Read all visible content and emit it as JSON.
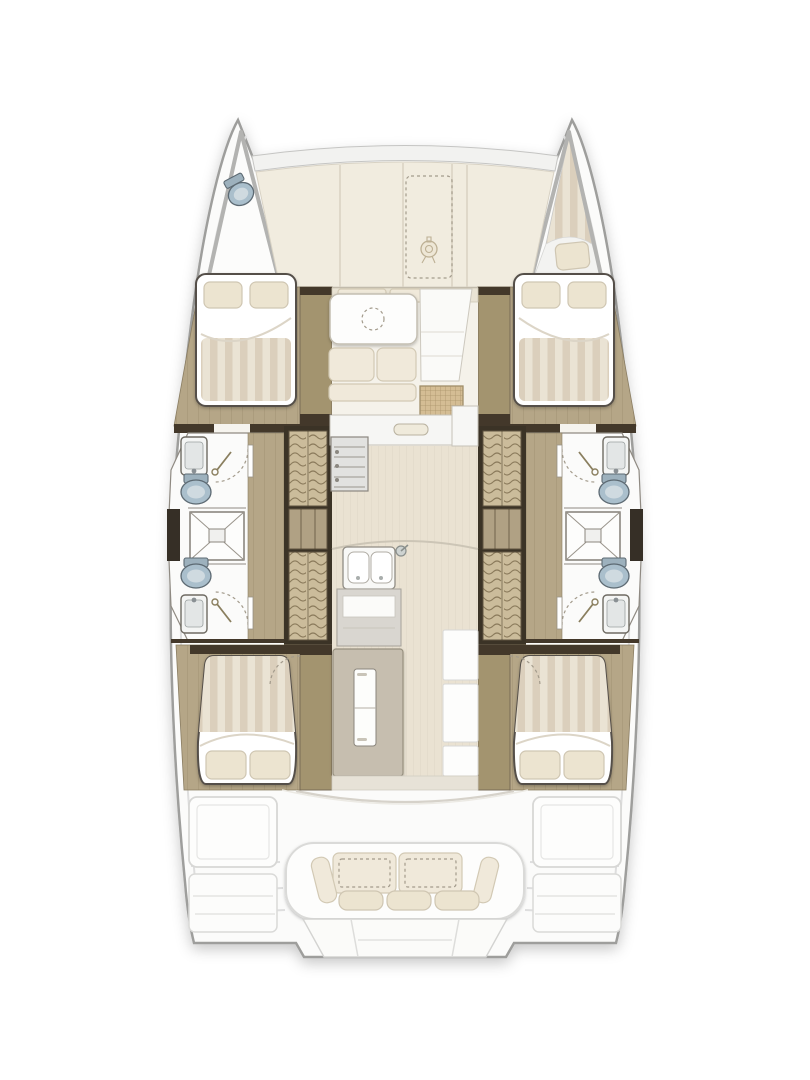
{
  "title": "Catamaran yacht deck floor plan, top view: four double cabins, four bathrooms with showers, twin companionway stairs, central salon with galley and dinette, foredeck anchor locker with windlass, aft cockpit bench sofa and swim-platform steps",
  "diagram": {
    "type": "floor-plan",
    "vessel": "sailing catamaran",
    "areas": {
      "bow_port": {
        "fixtures": [
          "sea-toilet"
        ]
      },
      "bow_starboard": {
        "fixtures": [
          "v-berth-cushion"
        ]
      },
      "foredeck": {
        "features": [
          "deck-panels",
          "anchor-locker-dashed-outline",
          "windlass"
        ]
      },
      "port_hull": {
        "rooms": [
          "forward-double-cabin",
          "forward-head-with-sink-and-toilet",
          "central-shower",
          "aft-head-with-toilet-and-sink",
          "companionway-stairs",
          "aft-double-cabin"
        ]
      },
      "starboard_hull": {
        "rooms": [
          "forward-double-cabin",
          "forward-head-with-sink-and-toilet",
          "central-shower",
          "aft-head-with-toilet-and-sink",
          "companionway-stairs",
          "aft-double-cabin"
        ]
      },
      "salon": {
        "features": [
          "forward-seating",
          "dinette-table-with-dashed-circle",
          "bench-cushions",
          "entry-mat",
          "galley-stove",
          "galley-worktop",
          "double-sink-with-faucet",
          "refrigerator",
          "storage-cabinets",
          "corridor"
        ]
      },
      "cockpit": {
        "features": [
          "bench-sofa",
          "back-cushions",
          "side-bolsters",
          "seat-cushions",
          "port-locker",
          "starboard-locker",
          "transom-steps",
          "swim-platform"
        ]
      }
    },
    "counts": {
      "double_cabins": 4,
      "heads": 4,
      "showers": 2,
      "stairways": 2,
      "cockpit_sofas": 1
    }
  },
  "colors": {
    "deck_white": "#fbfbfa",
    "hull_stroke": "#9e9e9c",
    "panel_cream": "#f1ecdf",
    "seam": "#d9d2c2",
    "wood": "#b5a687",
    "wood_dark": "#a3946f",
    "wall": "#43382a",
    "tread": "#cbbc9b",
    "stripe_a": "#dbcfbc",
    "stripe_b": "#eae3d4",
    "cushion": "#f0e9da",
    "cushion_stroke": "#d2c9b4",
    "pillow": "#ece4d0",
    "toilet": "#aabfcc",
    "fixture_stroke": "#5d6a73",
    "corridor": "#eae2d2",
    "mat": "#d4bd94",
    "dash": "#a39b8c",
    "furn_white": "#fdfdfc",
    "furn_stroke": "#d8d8d6"
  }
}
